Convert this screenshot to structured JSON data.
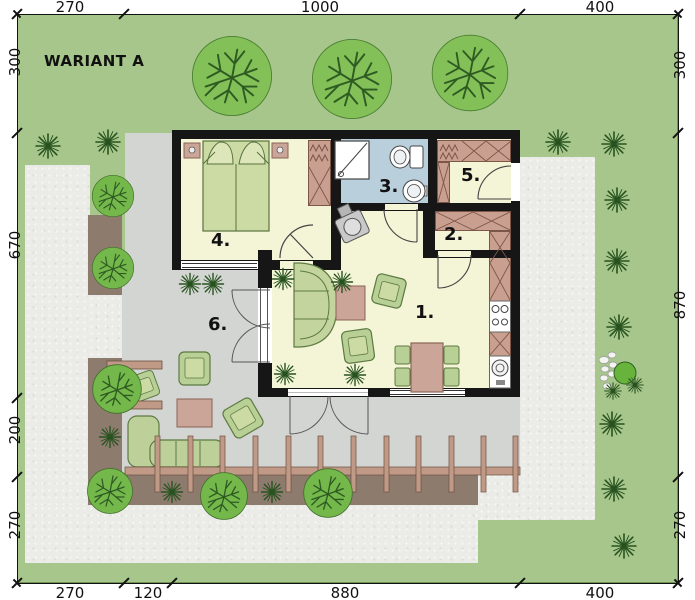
{
  "title": "WARIANT A",
  "rooms": [
    {
      "id": "living-room",
      "number": "1."
    },
    {
      "id": "entry-hall",
      "number": "2."
    },
    {
      "id": "bathroom",
      "number": "3."
    },
    {
      "id": "bedroom",
      "number": "4."
    },
    {
      "id": "storage",
      "number": "5."
    },
    {
      "id": "terrace",
      "number": "6."
    }
  ],
  "dimensions": {
    "top": [
      "270",
      "1000",
      "400"
    ],
    "bottom": [
      "270",
      "120",
      "880",
      "400"
    ],
    "left": [
      "300",
      "670",
      "200",
      "270"
    ],
    "right": [
      "300",
      "870",
      "270"
    ]
  },
  "colors": {
    "lawn": "#a7c68b",
    "gravel": "#ebebe7",
    "terrace_paving": "#d3d5d2",
    "flower_bed": "#8d7b6e",
    "wall": "#161616",
    "floor": "#f3f5d6",
    "bathroom_floor": "#bacfdc",
    "furniture_green": "#b8cf96",
    "furniture_wood": "#cba597",
    "tree": "#83c058"
  }
}
